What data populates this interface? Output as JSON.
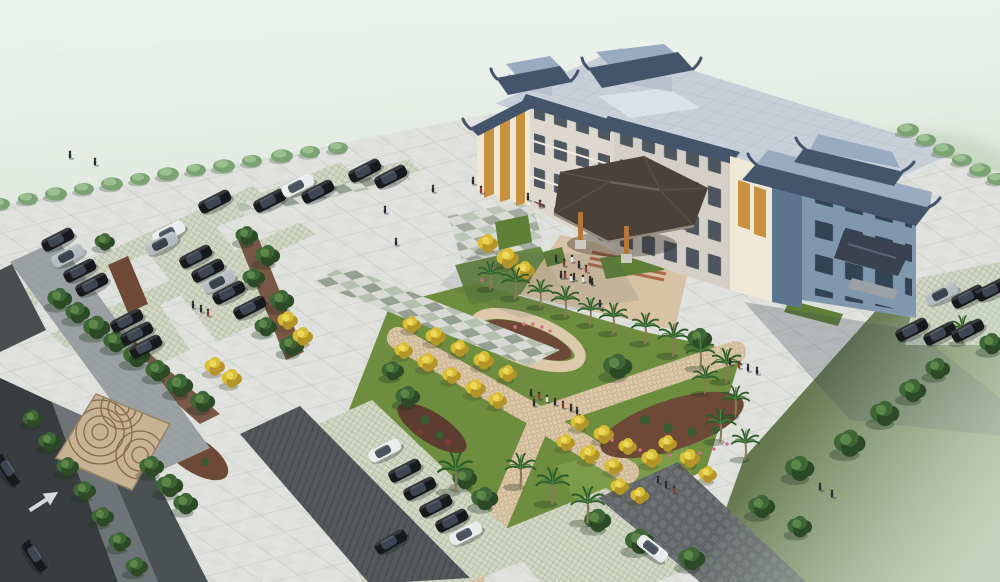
{
  "scene": {
    "description": "Hazy aerial architectural rendering: Chinese-eave office building with grey tiled roofs and rooftop pavilions, wood-column entrance canopy, large paved plaza with pedestrians, X-shaped garden paths lined with yellow ginkgo and palm trees, flower beds, grass-paver parking lots full of dark cars, perimeter roads with a turn arrow, lawns fading into fog"
  },
  "palette": {
    "fog-top": "#eaf0ea",
    "fog-mid": "#d8e2d8",
    "fog-low": "#c4d2c4",
    "site-base": "#e2e3e0",
    "plaza-grid": "#c9cac6",
    "checker-a": "#d8d9d4",
    "checker-b": "#b4bfae",
    "checker-c": "#969f93",
    "grass-bright": "#6f8d3f",
    "grass-light": "#7d9c49",
    "grass-deep": "#5f7f37",
    "lawn-near": "#5c6f47",
    "lawn-far": "#aebfa0",
    "path-beige": "#dcc9ab",
    "path-beige-line": "#c2a984",
    "mulch": "#6e4937",
    "mulch-dark": "#5d3d2f",
    "lattice-bg": "#d2d7c5",
    "lattice-line": "#a8b29b",
    "aisle-dark": "#54585a",
    "herring-line": "#464a4c",
    "road-asphalt": "#393d3f",
    "road-mark": "#e9ebeb",
    "walkway-grey": "#9ba1a3",
    "sidewalk-grey": "#6d7376",
    "innerpath-grey": "#4b5053",
    "stone-road": "#6e7274",
    "fan-bg": "#c7b293",
    "fan-line": "#85684c",
    "forecourt-warm": "#d7bf9f",
    "step-red": "#a85a38",
    "roof-main": "#c7d0d9",
    "roof-grid": "#afbbc7",
    "eave-dark": "#44546b",
    "roof-pav-top": "#99abc0",
    "pav-wall": "#b9c2cc",
    "wall-cream": "#efe8d7",
    "wall-front": "#dcd8ce",
    "wall-mid": "#d4d0c7",
    "wall-blue": "#8098ae",
    "wall-blue-dark": "#5e7590",
    "win-dark": "#3a4450",
    "win-orange": "#c8913f",
    "canopy-dark": "#4a4238",
    "canopy-ridge": "#6b6158",
    "canopy-edge": "#968b7e",
    "wood": "#b5763a",
    "shadow-col": "rgba(58,70,86,0.27)",
    "tree-dark": "#2c4a26",
    "tree-mid": "#3f6637",
    "tree-light": "#5d8748",
    "ytree-main": "#d9bd35",
    "ytree-light": "#ecd95a",
    "ytree-dark": "#b3952a",
    "palm-leaf": "#2f5c2a",
    "palm-leaf-light": "#4e8040",
    "palm-trunk": "#8b7a58",
    "shrub-main": "#7ba272",
    "shrub-light": "#9cbf90",
    "car-black-body": "#17191d",
    "car-black-cab": "#3e4654",
    "car-white-body": "#e9ebec",
    "car-white-cab": "#4a535f",
    "car-silver-body": "#b5bbc1",
    "car-silver-cab": "#3a424e",
    "person-dark": "#262b33",
    "person-red": "#8f3b33",
    "person-white": "#e3e4e4",
    "person-blue": "#2e4a6b",
    "forest-haze": "#9dbb93",
    "forest-green": "#7fa577"
  },
  "instances": {
    "cars": [
      [
        58,
        240,
        -27,
        "black"
      ],
      [
        68,
        256,
        -27,
        "silver"
      ],
      [
        80,
        271,
        -27,
        "black"
      ],
      [
        92,
        285,
        -27,
        "black"
      ],
      [
        127,
        321,
        -27,
        "black"
      ],
      [
        137,
        334,
        -27,
        "black"
      ],
      [
        146,
        347,
        -27,
        "black"
      ],
      [
        169,
        233,
        -27,
        "white"
      ],
      [
        162,
        244,
        -27,
        "silver"
      ],
      [
        196,
        257,
        -27,
        "black"
      ],
      [
        208,
        271,
        -27,
        "black"
      ],
      [
        219,
        282,
        -27,
        "silver"
      ],
      [
        229,
        293,
        -27,
        "black"
      ],
      [
        250,
        308,
        -27,
        "black"
      ],
      [
        215,
        202,
        -27,
        "black"
      ],
      [
        270,
        201,
        -27,
        "black"
      ],
      [
        298,
        186,
        -27,
        "white"
      ],
      [
        318,
        192,
        -27,
        "black"
      ],
      [
        365,
        171,
        -27,
        "black"
      ],
      [
        391,
        177,
        -27,
        "black"
      ],
      [
        385,
        451,
        -27,
        "white"
      ],
      [
        405,
        471,
        -27,
        "black"
      ],
      [
        420,
        489,
        -27,
        "black"
      ],
      [
        436,
        506,
        -27,
        "black"
      ],
      [
        452,
        521,
        -27,
        "black"
      ],
      [
        466,
        534,
        -27,
        "white"
      ],
      [
        391,
        542,
        -30,
        "black"
      ],
      [
        942,
        294,
        -27,
        "silver"
      ],
      [
        968,
        297,
        -27,
        "black"
      ],
      [
        992,
        290,
        -27,
        "black"
      ],
      [
        912,
        330,
        -27,
        "black"
      ],
      [
        940,
        334,
        -27,
        "black"
      ],
      [
        968,
        331,
        -27,
        "black"
      ],
      [
        35,
        556,
        57,
        "black"
      ],
      [
        8,
        470,
        57,
        "black"
      ],
      [
        652,
        549,
        38,
        "white"
      ]
    ],
    "trees": [
      [
        60,
        300,
        1.1
      ],
      [
        78,
        314,
        1.1
      ],
      [
        97,
        329,
        1.2
      ],
      [
        116,
        343,
        1.1
      ],
      [
        137,
        357,
        1.2
      ],
      [
        158,
        372,
        1.1
      ],
      [
        180,
        387,
        1.2
      ],
      [
        203,
        403,
        1.1
      ],
      [
        247,
        237,
        1.0
      ],
      [
        268,
        257,
        1.1
      ],
      [
        254,
        279,
        1.0
      ],
      [
        282,
        302,
        1.1
      ],
      [
        266,
        328,
        1.0
      ],
      [
        292,
        347,
        1.1
      ],
      [
        105,
        243,
        0.9
      ],
      [
        152,
        468,
        1.1
      ],
      [
        170,
        487,
        1.2
      ],
      [
        186,
        505,
        1.1
      ],
      [
        33,
        420,
        0.9
      ],
      [
        50,
        443,
        1.0
      ],
      [
        68,
        468,
        1.0
      ],
      [
        85,
        492,
        1.0
      ],
      [
        103,
        518,
        1.0
      ],
      [
        120,
        543,
        1.0
      ],
      [
        137,
        568,
        1.0
      ],
      [
        800,
        470,
        1.3
      ],
      [
        850,
        445,
        1.4
      ],
      [
        885,
        415,
        1.3
      ],
      [
        913,
        392,
        1.2
      ],
      [
        938,
        370,
        1.1
      ],
      [
        598,
        522,
        1.2
      ],
      [
        640,
        543,
        1.3
      ],
      [
        692,
        560,
        1.2
      ],
      [
        762,
        508,
        1.2
      ],
      [
        800,
        528,
        1.1
      ],
      [
        618,
        368,
        1.3
      ],
      [
        700,
        340,
        1.1
      ],
      [
        393,
        372,
        1.0
      ],
      [
        408,
        398,
        1.1
      ],
      [
        465,
        480,
        1.1
      ],
      [
        485,
        500,
        1.2
      ],
      [
        992,
        345,
        1.1
      ]
    ],
    "yellow_trees": [
      [
        215,
        368,
        1.1
      ],
      [
        232,
        380,
        1.1
      ],
      [
        288,
        322,
        1.1
      ],
      [
        303,
        338,
        1.1
      ],
      [
        412,
        326,
        1.0
      ],
      [
        436,
        338,
        1.1
      ],
      [
        460,
        350,
        1.0
      ],
      [
        484,
        362,
        1.1
      ],
      [
        508,
        375,
        1.0
      ],
      [
        404,
        352,
        1.0
      ],
      [
        428,
        364,
        1.1
      ],
      [
        452,
        377,
        1.0
      ],
      [
        476,
        390,
        1.1
      ],
      [
        498,
        402,
        1.0
      ],
      [
        580,
        424,
        1.0
      ],
      [
        604,
        436,
        1.1
      ],
      [
        628,
        448,
        1.0
      ],
      [
        652,
        460,
        1.1
      ],
      [
        566,
        444,
        1.0
      ],
      [
        590,
        456,
        1.1
      ],
      [
        614,
        468,
        1.0
      ],
      [
        620,
        488,
        1.0
      ],
      [
        640,
        497,
        1.0
      ],
      [
        668,
        445,
        1.0
      ],
      [
        690,
        460,
        1.1
      ],
      [
        708,
        476,
        1.0
      ],
      [
        488,
        245,
        1.1
      ],
      [
        508,
        260,
        1.2
      ],
      [
        525,
        272,
        1.1
      ]
    ],
    "palms": [
      [
        490,
        288,
        1.0
      ],
      [
        515,
        297,
        1.1
      ],
      [
        540,
        306,
        1.0
      ],
      [
        565,
        315,
        1.1
      ],
      [
        590,
        324,
        1.0
      ],
      [
        613,
        332,
        1.1
      ],
      [
        645,
        342,
        1.1
      ],
      [
        673,
        354,
        1.2
      ],
      [
        700,
        367,
        1.1
      ],
      [
        726,
        380,
        1.2
      ],
      [
        705,
        392,
        1.0
      ],
      [
        735,
        415,
        1.1
      ],
      [
        720,
        440,
        1.2
      ],
      [
        745,
        458,
        1.1
      ],
      [
        455,
        490,
        1.4
      ],
      [
        520,
        485,
        1.2
      ],
      [
        552,
        502,
        1.3
      ],
      [
        587,
        521,
        1.3
      ],
      [
        962,
        342,
        1.0
      ]
    ],
    "shrubs": [
      [
        0,
        204,
        1.0
      ],
      [
        28,
        199,
        1.0
      ],
      [
        56,
        194,
        1.1
      ],
      [
        84,
        189,
        1.0
      ],
      [
        112,
        184,
        1.1
      ],
      [
        140,
        179,
        1.0
      ],
      [
        168,
        174,
        1.1
      ],
      [
        196,
        170,
        1.0
      ],
      [
        224,
        166,
        1.1
      ],
      [
        252,
        161,
        1.0
      ],
      [
        282,
        156,
        1.1
      ],
      [
        310,
        152,
        1.0
      ],
      [
        338,
        148,
        1.0
      ],
      [
        908,
        130,
        1.1
      ],
      [
        926,
        140,
        1.0
      ],
      [
        944,
        150,
        1.1
      ],
      [
        962,
        160,
        1.0
      ],
      [
        980,
        170,
        1.1
      ],
      [
        997,
        179,
        1.0
      ]
    ],
    "people": [
      [
        70,
        158,
        "dark"
      ],
      [
        95,
        165,
        "dark"
      ],
      [
        473,
        184,
        "dark"
      ],
      [
        481,
        193,
        "red"
      ],
      [
        433,
        192,
        "dark"
      ],
      [
        385,
        213,
        "dark"
      ],
      [
        396,
        245,
        "dark"
      ],
      [
        528,
        200,
        "dark"
      ],
      [
        540,
        207,
        "red"
      ],
      [
        565,
        278,
        "red"
      ],
      [
        574,
        280,
        "dark"
      ],
      [
        583,
        282,
        "white"
      ],
      [
        592,
        285,
        "dark"
      ],
      [
        600,
        307,
        "dark"
      ],
      [
        556,
        262,
        "dark"
      ],
      [
        564,
        266,
        "red"
      ],
      [
        572,
        262,
        "white"
      ],
      [
        579,
        268,
        "dark"
      ],
      [
        586,
        272,
        "red"
      ],
      [
        561,
        278,
        "dark"
      ],
      [
        571,
        281,
        "white"
      ],
      [
        590,
        283,
        "dark"
      ],
      [
        730,
        365,
        "dark"
      ],
      [
        739,
        368,
        "red"
      ],
      [
        748,
        371,
        "dark"
      ],
      [
        757,
        374,
        "dark"
      ],
      [
        531,
        396,
        "dark"
      ],
      [
        539,
        399,
        "red"
      ],
      [
        547,
        402,
        "white"
      ],
      [
        534,
        406,
        "dark"
      ],
      [
        555,
        405,
        "dark"
      ],
      [
        563,
        408,
        "red"
      ],
      [
        571,
        411,
        "dark"
      ],
      [
        577,
        414,
        "dark"
      ],
      [
        658,
        483,
        "dark"
      ],
      [
        666,
        488,
        "dark"
      ],
      [
        674,
        493,
        "red"
      ],
      [
        820,
        490,
        "dark"
      ],
      [
        832,
        497,
        "dark"
      ],
      [
        193,
        308,
        "dark"
      ],
      [
        201,
        312,
        "dark"
      ],
      [
        208,
        316,
        "red"
      ]
    ]
  }
}
